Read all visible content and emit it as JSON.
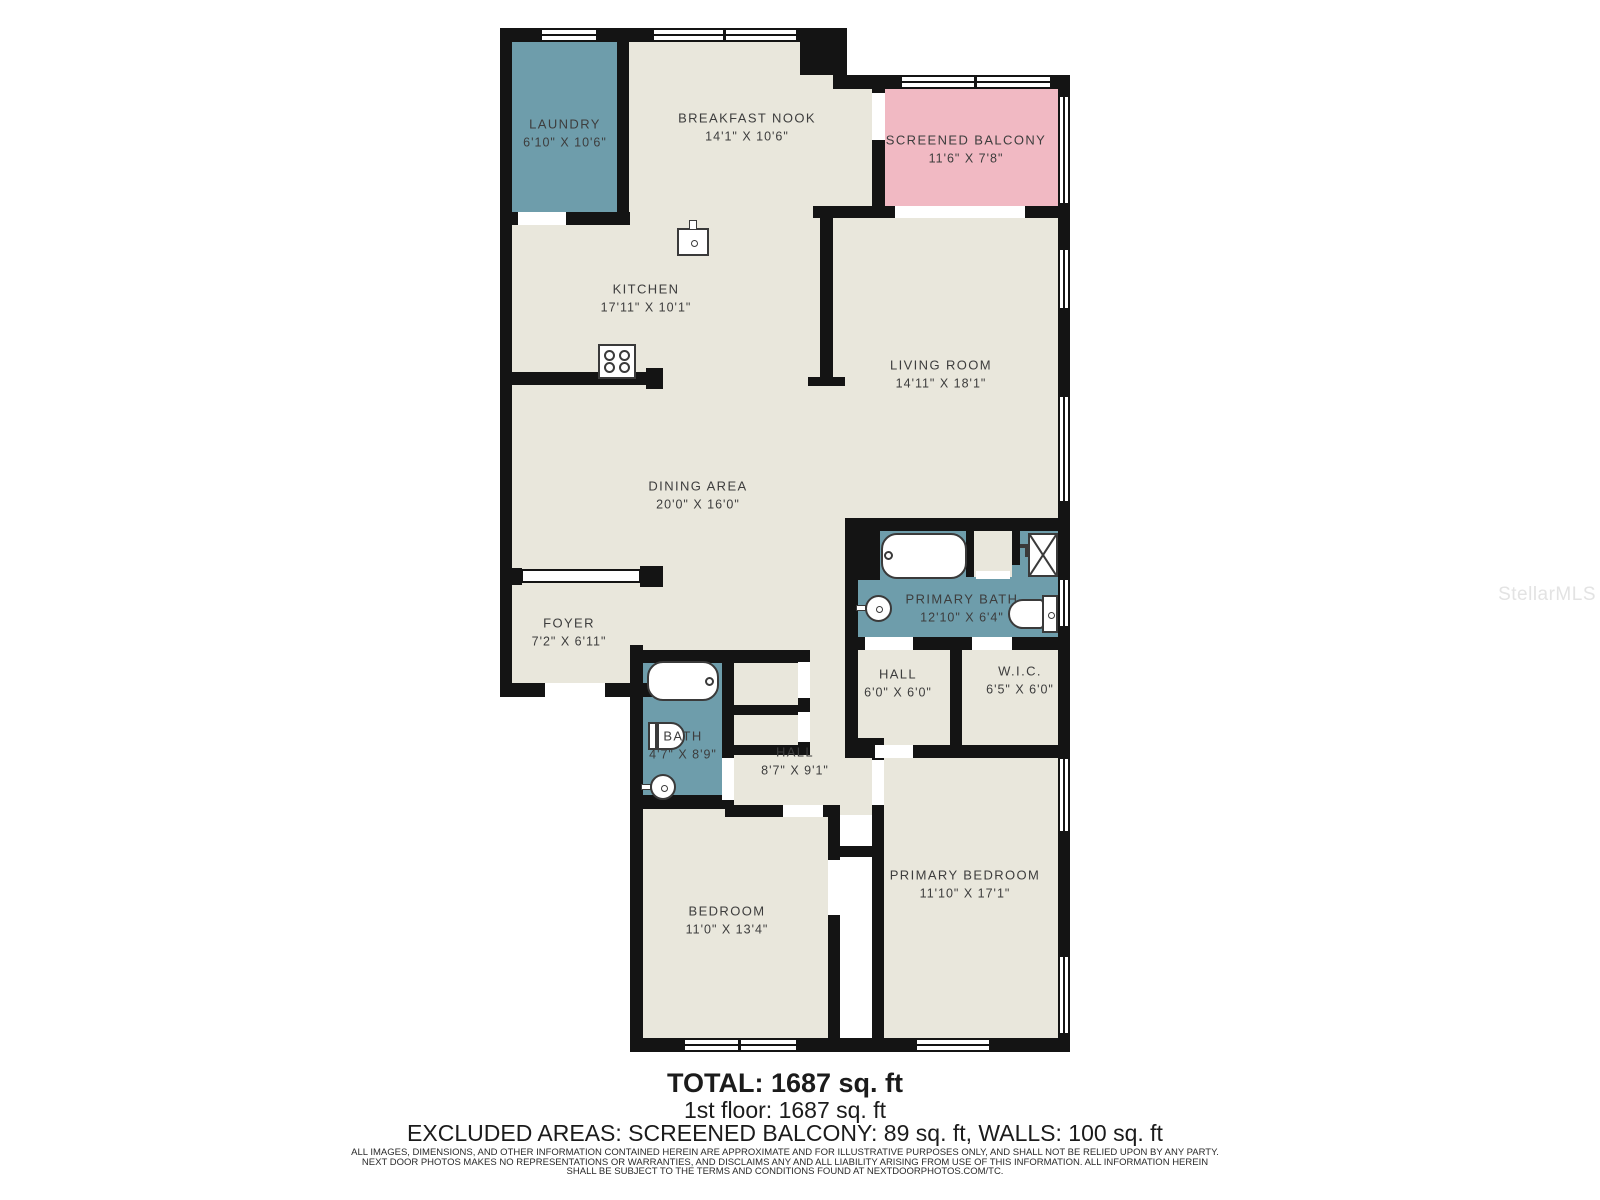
{
  "floorplan": {
    "rooms": [
      {
        "name": "LAUNDRY",
        "dims": "6'10\" X 10'6\""
      },
      {
        "name": "BREAKFAST NOOK",
        "dims": "14'1\" X 10'6\""
      },
      {
        "name": "SCREENED BALCONY",
        "dims": "11'6\" X 7'8\""
      },
      {
        "name": "KITCHEN",
        "dims": "17'11\" X 10'1\""
      },
      {
        "name": "LIVING ROOM",
        "dims": "14'11\" X 18'1\""
      },
      {
        "name": "DINING AREA",
        "dims": "20'0\" X 16'0\""
      },
      {
        "name": "FOYER",
        "dims": "7'2\" X 6'11\""
      },
      {
        "name": "PRIMARY BATH",
        "dims": "12'10\" X 6'4\""
      },
      {
        "name": "HALL",
        "dims": "6'0\" X 6'0\""
      },
      {
        "name": "W.I.C.",
        "dims": "6'5\" X 6'0\""
      },
      {
        "name": "BATH",
        "dims": "4'7\" X 8'9\""
      },
      {
        "name": "HALL",
        "dims": "8'7\" X 9'1\""
      },
      {
        "name": "BEDROOM",
        "dims": "11'0\" X 13'4\""
      },
      {
        "name": "PRIMARY BEDROOM",
        "dims": "11'10\" X 17'1\""
      }
    ],
    "colors": {
      "floor": "#e9e7dc",
      "wet_room": "#6e9dab",
      "balcony": "#f1b9c3",
      "wall": "#141414",
      "label_text": "#3d3d3d"
    }
  },
  "summary": {
    "total": "TOTAL: 1687 sq. ft",
    "floor1": "1st floor: 1687 sq. ft",
    "excluded": "EXCLUDED AREAS: SCREENED BALCONY: 89 sq. ft, WALLS: 100 sq. ft"
  },
  "disclaimer": {
    "line1": "ALL IMAGES, DIMENSIONS, AND OTHER INFORMATION CONTAINED HEREIN ARE APPROXIMATE AND FOR ILLUSTRATIVE PURPOSES ONLY, AND SHALL NOT BE RELIED UPON BY ANY PARTY.",
    "line2": "NEXT DOOR PHOTOS MAKES NO REPRESENTATIONS OR WARRANTIES, AND DISCLAIMS ANY AND ALL LIABILITY ARISING FROM USE OF THIS INFORMATION. ALL INFORMATION HEREIN",
    "line3": "SHALL BE SUBJECT TO THE TERMS AND CONDITIONS FOUND AT NEXTDOORPHOTOS.COM/TC."
  },
  "watermark": "StellarMLS"
}
